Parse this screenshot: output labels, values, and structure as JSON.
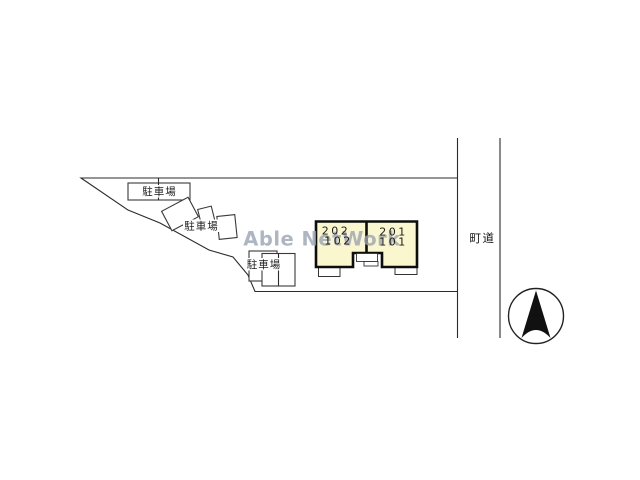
{
  "watermark": {
    "text": "Able NetWork",
    "color": "#9AA4B6"
  },
  "plan": {
    "parking_areas": [
      {
        "label": "駐車場"
      },
      {
        "label": "駐車場"
      },
      {
        "label": "駐車場"
      }
    ],
    "building": {
      "fill_color": "#FAF7CE",
      "units": [
        {
          "upper_room": "202",
          "lower_room": "102"
        },
        {
          "upper_room": "201",
          "lower_room": "101"
        }
      ]
    },
    "road": {
      "label": "町道"
    },
    "compass": {
      "icon": "north-arrow"
    }
  }
}
